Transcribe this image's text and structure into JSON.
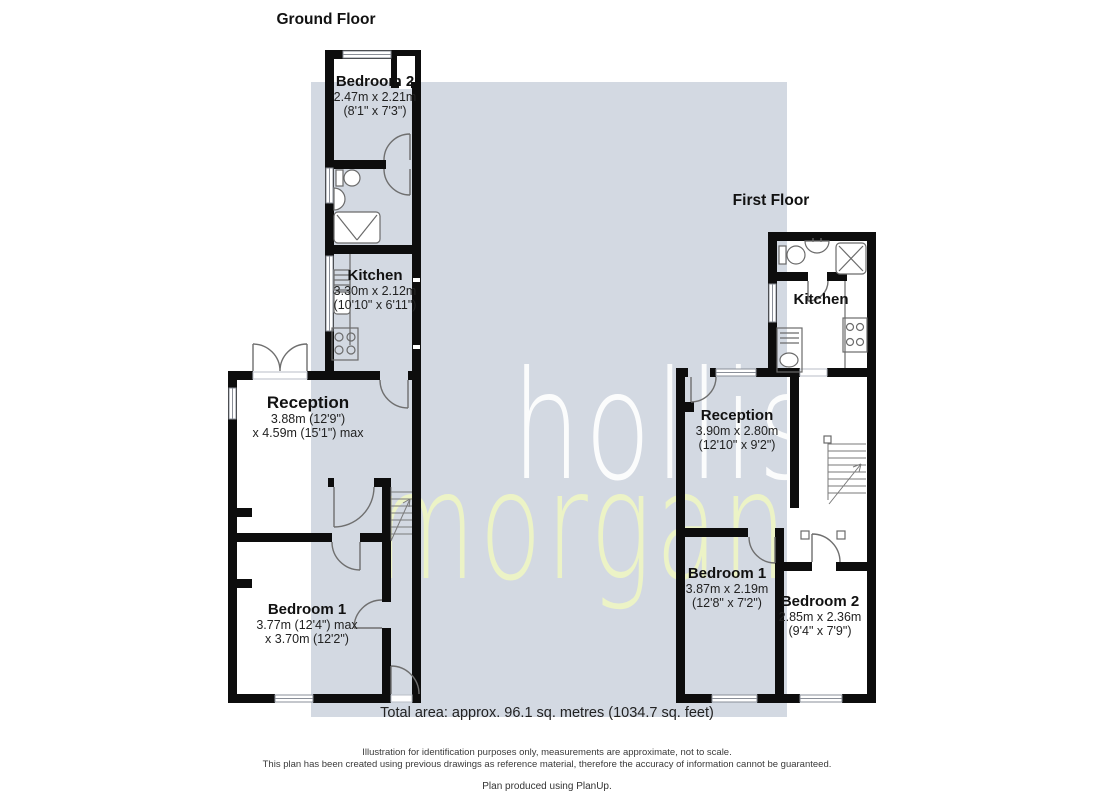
{
  "meta": {
    "watermark_bg": "#d3d9e2",
    "wall_color": "#0d0d0d",
    "fixture_color": "#6b6b6b",
    "hollis_color": "#ffffff",
    "morgan_color": "#eef5c5"
  },
  "watermark": {
    "line1": "hollis",
    "line2": "morgan"
  },
  "ground_floor": {
    "title": "Ground Floor",
    "rooms": [
      {
        "name": "Bedroom 2",
        "dim1": "2.47m x 2.21m",
        "dim2": "(8'1\" x 7'3\")"
      },
      {
        "name": "Kitchen",
        "dim1": "3.30m x 2.12m",
        "dim2": "(10'10\" x 6'11\")"
      },
      {
        "name": "Reception",
        "dim1": "3.88m (12'9\")",
        "dim2": "x 4.59m (15'1\") max"
      },
      {
        "name": "Bedroom 1",
        "dim1": "3.77m (12'4\") max",
        "dim2": "x 3.70m (12'2\")"
      }
    ]
  },
  "first_floor": {
    "title": "First Floor",
    "rooms": [
      {
        "name": "Kitchen"
      },
      {
        "name": "Reception",
        "dim1": "3.90m x 2.80m",
        "dim2": "(12'10\" x 9'2\")"
      },
      {
        "name": "Bedroom 1",
        "dim1": "3.87m x 2.19m",
        "dim2": "(12'8\" x 7'2\")"
      },
      {
        "name": "Bedroom 2",
        "dim1": "2.85m x 2.36m",
        "dim2": "(9'4\" x 7'9\")"
      }
    ]
  },
  "footer": {
    "total_area": "Total area: approx. 96.1 sq. metres (1034.7 sq. feet)",
    "disclaimer_line1": "Illustration for identification purposes only, measurements are approximate, not to scale.",
    "disclaimer_line2": "This plan has been created using previous drawings as reference material, therefore the accuracy of information cannot be guaranteed.",
    "credit": "Plan produced using PlanUp."
  }
}
